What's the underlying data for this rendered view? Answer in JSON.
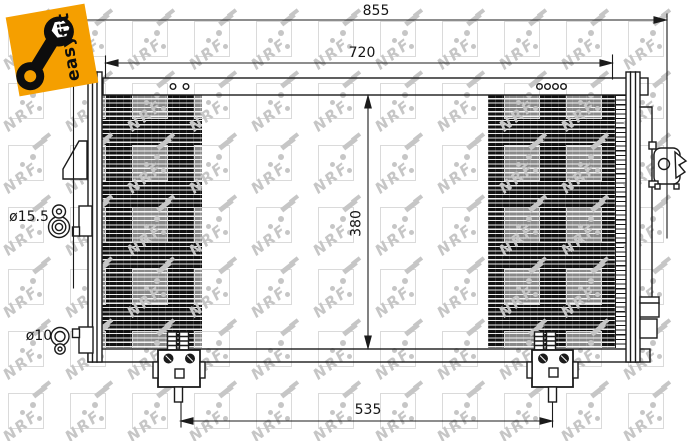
{
  "product_badge": {
    "label": "easyfit"
  },
  "watermark": {
    "text": "NRF"
  },
  "dimensions": {
    "overall_width": "855",
    "upper_mount_width": "720",
    "core_height": "380",
    "lower_bracket_span": "535",
    "upper_port_diameter": "ø15.5",
    "lower_port_diameter": "ø10"
  },
  "colors": {
    "badge_orange": "#f59f00",
    "line_black": "#1b1b1b",
    "watermark_gray": "#c6c6c6"
  }
}
